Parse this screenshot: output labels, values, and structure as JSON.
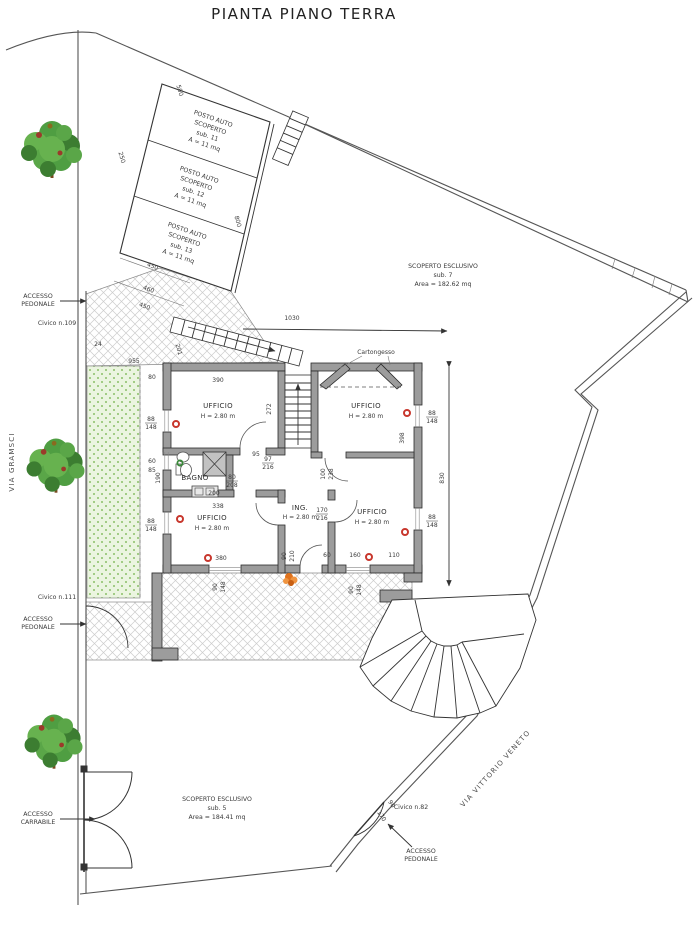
{
  "title": "PIANTA PIANO TERRA",
  "streets": {
    "left": "VIA GRAMSCI",
    "right": "VIA VITTORIO VENETO"
  },
  "access": {
    "l1": "ACCESSO",
    "pedonale": "PEDONALE",
    "carrabile": "CARRABILE"
  },
  "civico": {
    "n109": "Civico n.109",
    "n111": "Civico n.111",
    "n82": "Civico n.82"
  },
  "parking": {
    "row_label1": "POSTO AUTO",
    "row_label2": "SCOPERTO",
    "stalls": [
      {
        "sub": "sub. 11",
        "area": "A = 11 mq"
      },
      {
        "sub": "sub. 12",
        "area": "A = 11 mq"
      },
      {
        "sub": "sub. 13",
        "area": "A = 11 mq"
      }
    ]
  },
  "scoperto": {
    "right": {
      "name": "SCOPERTO ESCLUSIVO",
      "sub": "sub. 7",
      "area": "Area = 182.62 mq"
    },
    "bottom": {
      "name": "SCOPERTO ESCLUSIVO",
      "sub": "sub. 5",
      "area": "Area = 184.41 mq"
    }
  },
  "rooms": {
    "ufficio": {
      "name": "UFFICIO",
      "h": "H = 2.80 m"
    },
    "bagno": {
      "name": "BAGNO"
    },
    "ing": {
      "name": "ING.",
      "h": "H = 2.80 m"
    }
  },
  "notes": {
    "cartongesso": "Cartongesso"
  },
  "colors": {
    "wall": "#9c9c9c",
    "line": "#3a3a3a",
    "garden": "#ebf5e0",
    "garden_dot": "#8abf68",
    "tree": "#4f9e42",
    "marker_red": "#c8372d",
    "marker_green": "#3a8a3a",
    "plant_orange": "#e0731d",
    "hatch": "#cccccc"
  },
  "dimensions": [
    {
      "t": "500",
      "x": 178,
      "y": 91,
      "r": 73
    },
    {
      "t": "250",
      "x": 120,
      "y": 158,
      "r": 73
    },
    {
      "t": "800",
      "x": 236,
      "y": 222,
      "r": 73
    },
    {
      "t": "450",
      "x": 152,
      "y": 268,
      "r": 20
    },
    {
      "t": "460",
      "x": 148,
      "y": 291,
      "r": 20
    },
    {
      "t": "450",
      "x": 144,
      "y": 308,
      "r": 20
    },
    {
      "t": "24",
      "x": 98,
      "y": 346
    },
    {
      "t": "955",
      "x": 134,
      "y": 363
    },
    {
      "t": "201",
      "x": 177,
      "y": 350,
      "r": 73
    },
    {
      "t": "1030",
      "x": 292,
      "y": 320
    },
    {
      "t": "830",
      "x": 444,
      "y": 478,
      "r": -90
    },
    {
      "t": "390",
      "x": 218,
      "y": 382
    },
    {
      "t": "272",
      "x": 271,
      "y": 409,
      "r": -90
    },
    {
      "t": "398",
      "x": 404,
      "y": 438,
      "r": -90
    },
    {
      "t": "95",
      "x": 256,
      "y": 456
    },
    {
      "t": "97",
      "x": 268,
      "y": 461,
      "f": 1
    },
    {
      "t": "216",
      "x": 268,
      "y": 469
    },
    {
      "t": "80",
      "x": 232,
      "y": 479,
      "f": 1
    },
    {
      "t": "208",
      "x": 232,
      "y": 487
    },
    {
      "t": "200",
      "x": 214,
      "y": 495
    },
    {
      "t": "338",
      "x": 218,
      "y": 508
    },
    {
      "t": "190",
      "x": 160,
      "y": 478,
      "r": -90
    },
    {
      "t": "80",
      "x": 152,
      "y": 379
    },
    {
      "t": "88",
      "x": 151,
      "y": 421,
      "f": 1
    },
    {
      "t": "148",
      "x": 151,
      "y": 429
    },
    {
      "t": "60",
      "x": 152,
      "y": 463
    },
    {
      "t": "85",
      "x": 152,
      "y": 472
    },
    {
      "t": "88",
      "x": 151,
      "y": 523,
      "f": 1
    },
    {
      "t": "148",
      "x": 151,
      "y": 531
    },
    {
      "t": "88",
      "x": 432,
      "y": 415,
      "f": 1
    },
    {
      "t": "148",
      "x": 432,
      "y": 423
    },
    {
      "t": "88",
      "x": 432,
      "y": 519,
      "f": 1
    },
    {
      "t": "148",
      "x": 432,
      "y": 527
    },
    {
      "t": "100",
      "x": 325,
      "y": 474,
      "r": -90
    },
    {
      "t": "238",
      "x": 333,
      "y": 474,
      "r": -90
    },
    {
      "t": "170",
      "x": 322,
      "y": 512,
      "f": 1
    },
    {
      "t": "216",
      "x": 322,
      "y": 520
    },
    {
      "t": "90",
      "x": 286,
      "y": 556,
      "r": -90
    },
    {
      "t": "210",
      "x": 294,
      "y": 556,
      "r": -90
    },
    {
      "t": "380",
      "x": 221,
      "y": 560
    },
    {
      "t": "60",
      "x": 327,
      "y": 557
    },
    {
      "t": "160",
      "x": 355,
      "y": 557
    },
    {
      "t": "110",
      "x": 394,
      "y": 557
    },
    {
      "t": "90",
      "x": 217,
      "y": 587,
      "r": -90
    },
    {
      "t": "148",
      "x": 225,
      "y": 587,
      "r": -90
    },
    {
      "t": "90",
      "x": 353,
      "y": 590,
      "r": -90
    },
    {
      "t": "148",
      "x": 361,
      "y": 590,
      "r": -90
    },
    {
      "t": "170",
      "x": 380,
      "y": 817,
      "r": 57
    },
    {
      "t": "90",
      "x": 390,
      "y": 805,
      "r": 57
    }
  ]
}
